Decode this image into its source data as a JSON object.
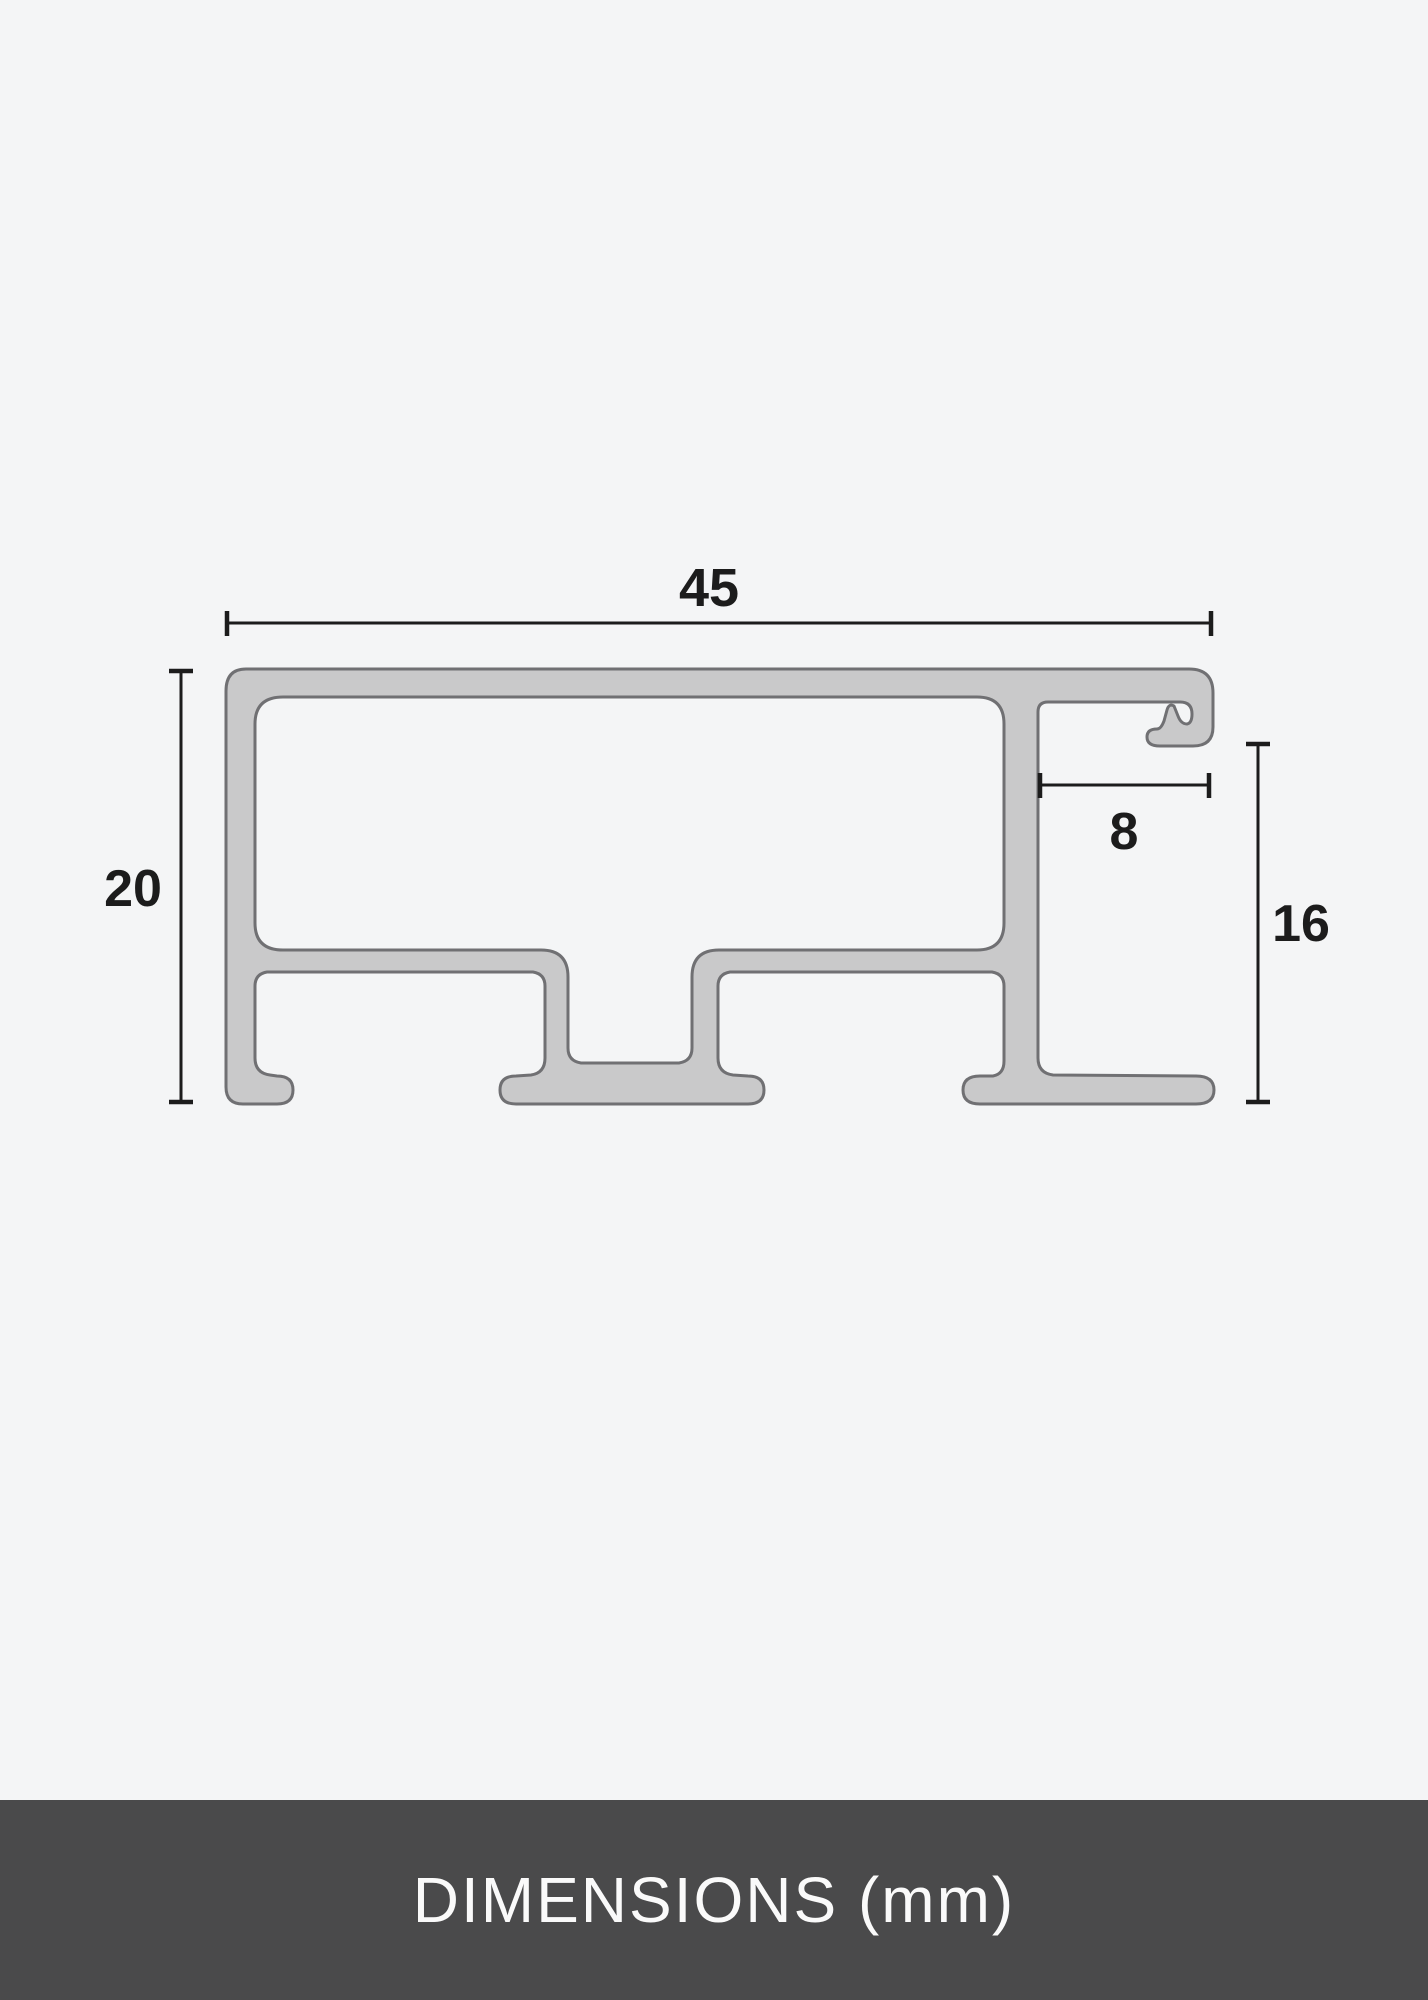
{
  "colors": {
    "page_bg": "#f4f5f6",
    "profile_fill": "#c9c9ca",
    "profile_stroke": "#707073",
    "dim_color": "#1c1c1c",
    "footer_bg": "#4a4a4b",
    "footer_text": "#fafafa"
  },
  "diagram": {
    "dimensions": {
      "overall_width": "45",
      "overall_height": "20",
      "rabbet_width": "8",
      "rabbet_height": "16"
    }
  },
  "footer": {
    "label": "DIMENSIONS (mm)"
  }
}
